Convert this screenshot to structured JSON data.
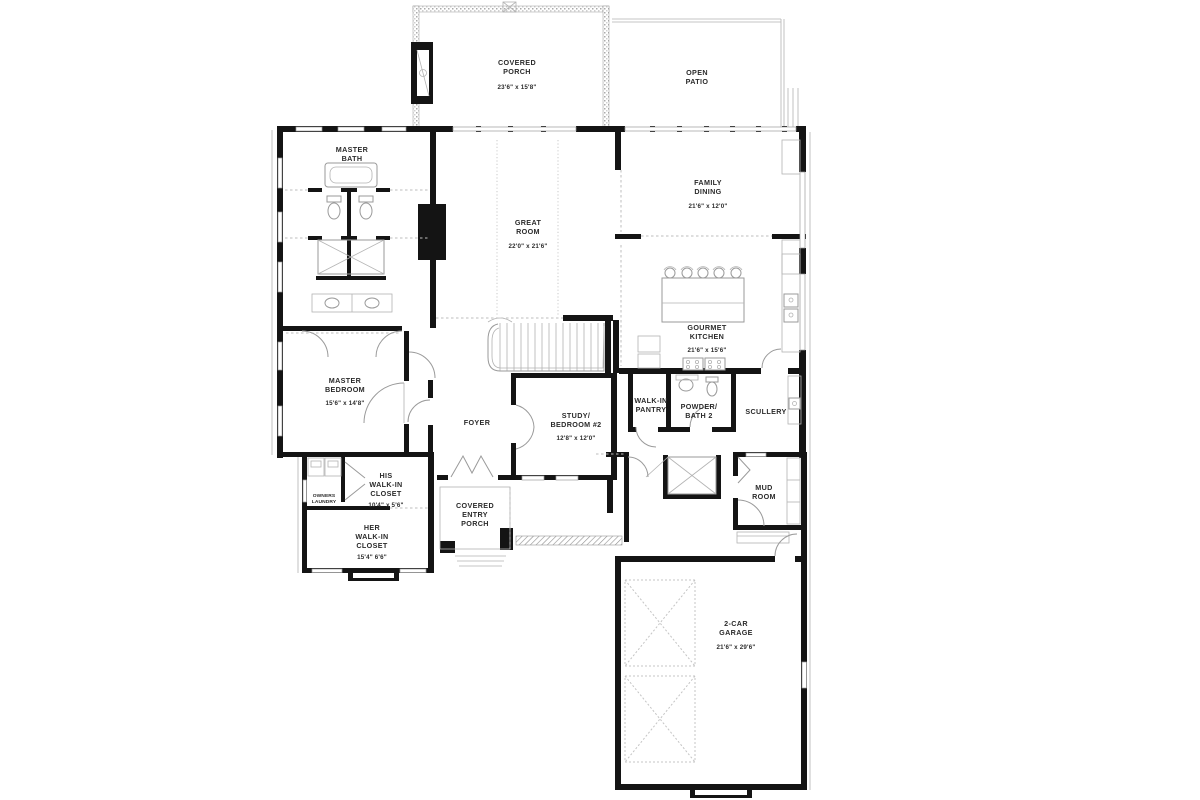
{
  "plan": {
    "type": "architectural-floor-plan",
    "colors": {
      "wall": "#141414",
      "thin_line": "#9a9a9a",
      "dashed": "#bdbdbd",
      "label": "#2b2b2b",
      "background": "#ffffff"
    },
    "rooms": {
      "covered_porch": {
        "l1": "COVERED",
        "l2": "PORCH",
        "dim": "23'6\" x 15'8\""
      },
      "open_patio": {
        "l1": "OPEN",
        "l2": "PATIO"
      },
      "master_bath": {
        "l1": "MASTER",
        "l2": "BATH"
      },
      "great_room": {
        "l1": "GREAT",
        "l2": "ROOM",
        "dim": "22'0\" x 21'6\""
      },
      "family_dining": {
        "l1": "FAMILY",
        "l2": "DINING",
        "dim": "21'6\" x 12'0\""
      },
      "gourmet_kitchen": {
        "l1": "GOURMET",
        "l2": "KITCHEN",
        "dim": "21'6\" x 15'6\""
      },
      "master_bedroom": {
        "l1": "MASTER",
        "l2": "BEDROOM",
        "dim": "15'6\" x 14'8\""
      },
      "foyer": {
        "l1": "FOYER"
      },
      "study_bedroom2": {
        "l1": "STUDY/",
        "l2": "BEDROOM #2",
        "dim": "12'8\" x 12'0\""
      },
      "walk_in_pantry": {
        "l1": "WALK-IN",
        "l2": "PANTRY"
      },
      "powder_bath2": {
        "l1": "POWDER/",
        "l2": "BATH 2"
      },
      "scullery": {
        "l1": "SCULLERY"
      },
      "owners_laundry": {
        "l1": "OWNERS",
        "l2": "LAUNDRY"
      },
      "his_closet": {
        "l1": "HIS",
        "l2": "WALK-IN",
        "l3": "CLOSET",
        "dim": "10'4\" x 5'6\""
      },
      "her_closet": {
        "l1": "HER",
        "l2": "WALK-IN",
        "l3": "CLOSET",
        "dim": "15'4\" 6'6\""
      },
      "covered_entry_porch": {
        "l1": "COVERED",
        "l2": "ENTRY",
        "l3": "PORCH"
      },
      "mud_room": {
        "l1": "MUD",
        "l2": "ROOM"
      },
      "garage": {
        "l1": "2-CAR",
        "l2": "GARAGE",
        "dim": "21'6\" x 29'6\""
      }
    }
  }
}
